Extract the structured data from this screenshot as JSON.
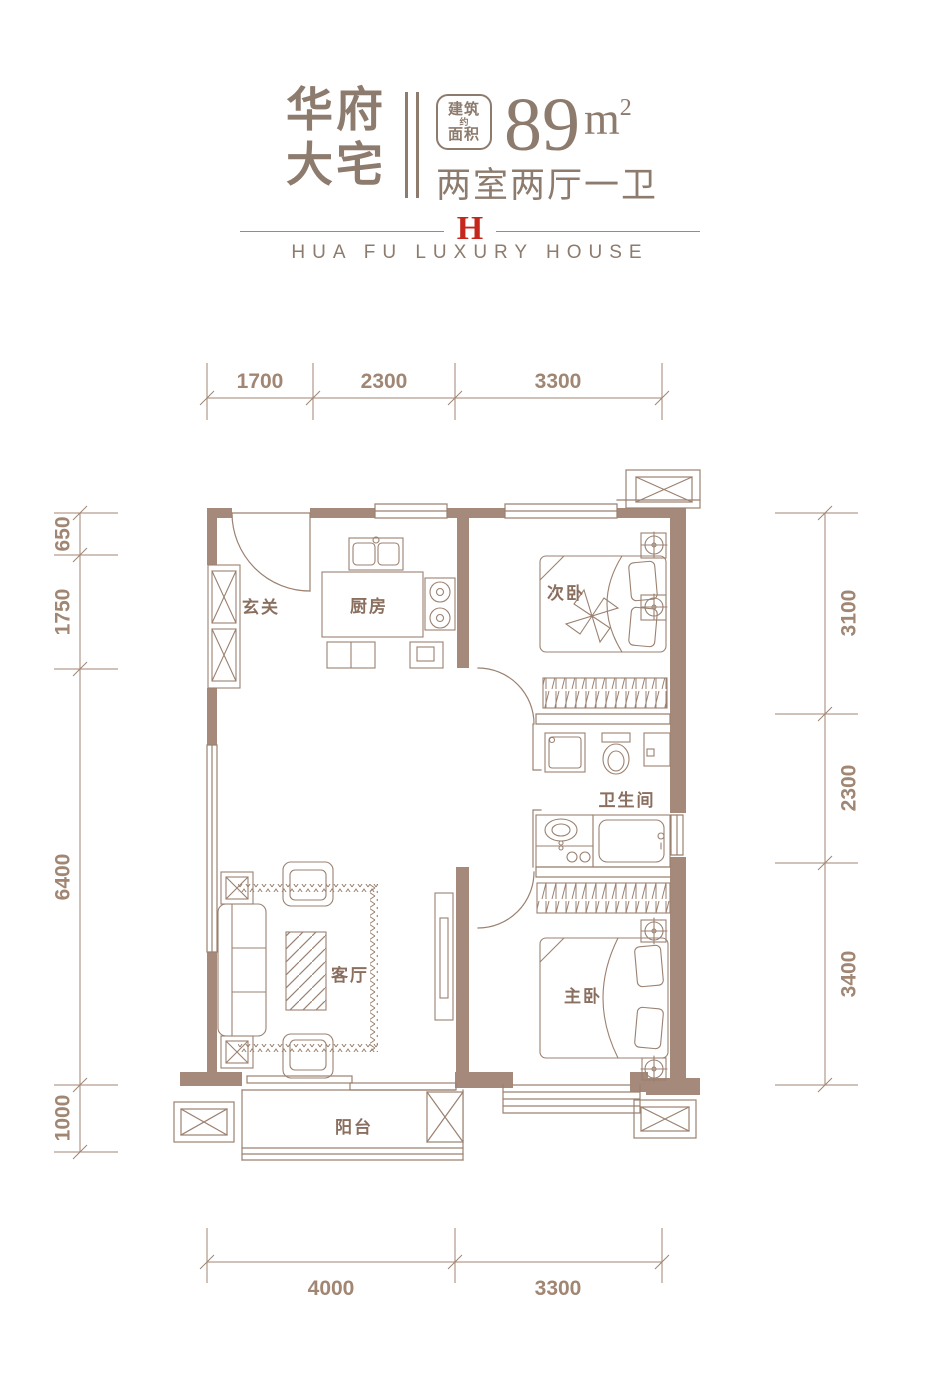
{
  "header": {
    "title_line1": "华府",
    "title_line2": "大宅",
    "area_badge": {
      "top": "建筑",
      "mid": "约",
      "bottom": "面积"
    },
    "area_value": "89",
    "area_unit_base": "m",
    "area_unit_exp": "2",
    "layout_text": "两室两厅一卫",
    "logo_letter": "H",
    "subtitle": "HUA FU LUXURY HOUSE"
  },
  "rooms": [
    {
      "name": "entry",
      "label": "玄关"
    },
    {
      "name": "kitchen",
      "label": "厨房"
    },
    {
      "name": "second-bedroom",
      "label": "次卧"
    },
    {
      "name": "bathroom",
      "label": "卫生间"
    },
    {
      "name": "living-room",
      "label": "客厅"
    },
    {
      "name": "master-bedroom",
      "label": "主卧"
    },
    {
      "name": "balcony",
      "label": "阳台"
    }
  ],
  "dimensions": {
    "top": [
      "1700",
      "2300",
      "3300"
    ],
    "bottom": [
      "4000",
      "3300"
    ],
    "left": [
      "650",
      "1750",
      "6400",
      "1000"
    ],
    "right": [
      "3100",
      "2300",
      "3400"
    ]
  },
  "colors": {
    "wall_fill": "#a5897a",
    "line": "#9b8170",
    "dim": "#a08673",
    "header_text": "#8d7b6d",
    "room_label": "#8a6f5f",
    "logo_red": "#c5271d"
  }
}
